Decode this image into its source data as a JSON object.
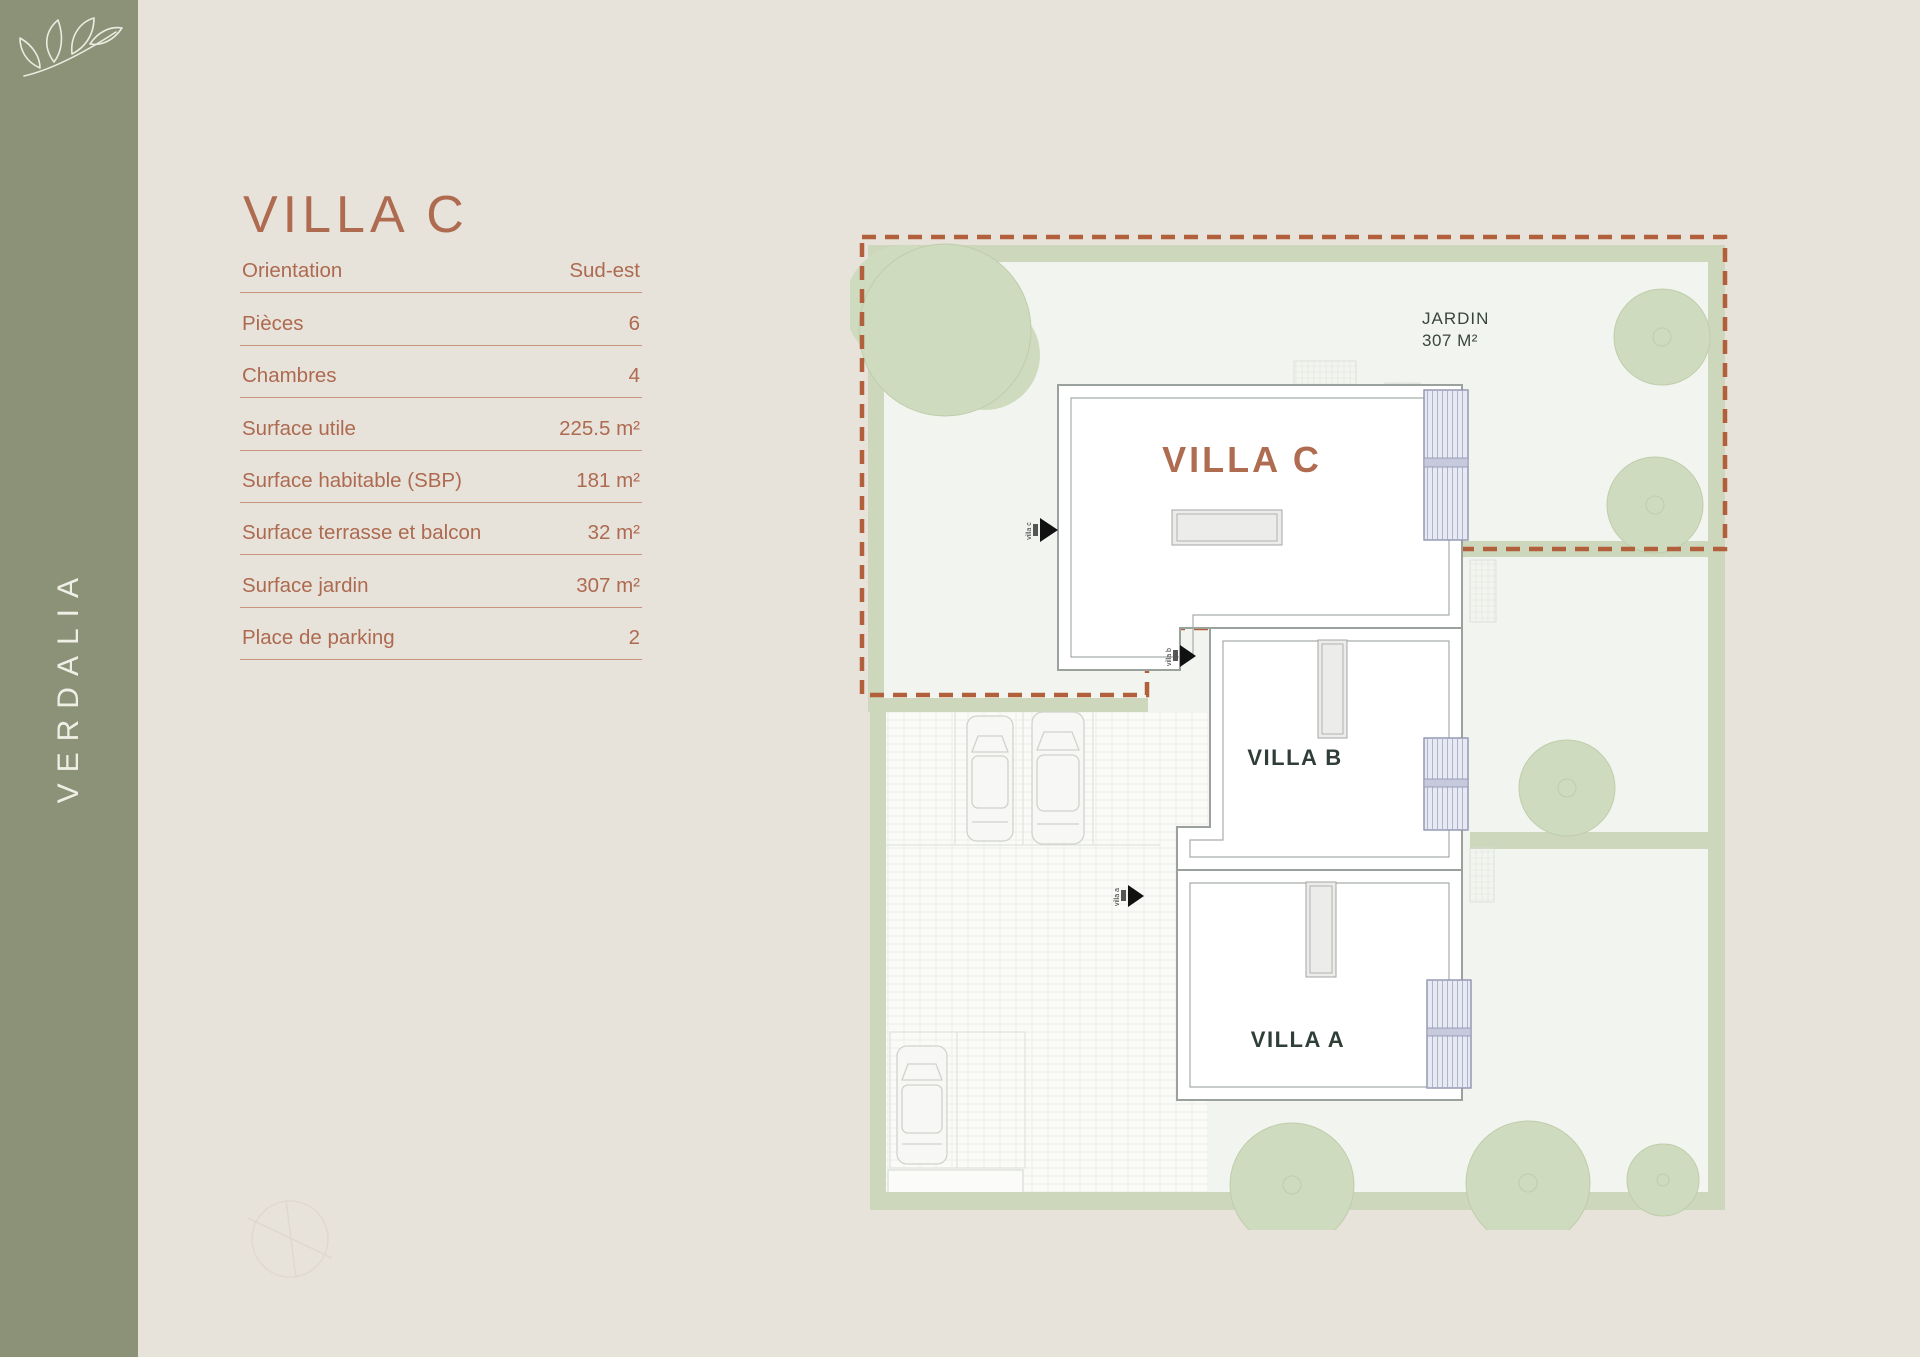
{
  "brand": {
    "name": "VERDALIA",
    "logo": "leaf-branch-icon"
  },
  "page": {
    "title": "VILLA C"
  },
  "specs": {
    "rows": [
      {
        "label": "Orientation",
        "value": "Sud-est"
      },
      {
        "label": "Pièces",
        "value": "6"
      },
      {
        "label": "Chambres",
        "value": "4"
      },
      {
        "label": "Surface utile",
        "value": "225.5 m²"
      },
      {
        "label": "Surface habitable (SBP)",
        "value": "181 m²"
      },
      {
        "label": "Surface terrasse et balcon",
        "value": "32 m²"
      },
      {
        "label": "Surface jardin",
        "value": "307 m²"
      },
      {
        "label": "Place de parking",
        "value": "2"
      }
    ]
  },
  "plan": {
    "jardin": {
      "line1": "JARDIN",
      "line2": "307 M²"
    },
    "villas": {
      "c": "VILLA C",
      "b": "VILLA B",
      "a": "VILLA A"
    },
    "entrances": {
      "c": "villa c",
      "b": "villa b",
      "a": "villa a"
    }
  },
  "colors": {
    "sidebar_green": "#8B9278",
    "background_beige": "#E8E3DA",
    "accent_terracotta": "#AE6B50",
    "boundary_dashed_terracotta": "#B2603C",
    "hedge_green": "#CCD7BB",
    "tree_green": "#CEDBBF",
    "plan_ground": "#F2F5EF",
    "dark_label_green": "#2F3E36",
    "shutter_lavender": "#E7E9F3"
  }
}
